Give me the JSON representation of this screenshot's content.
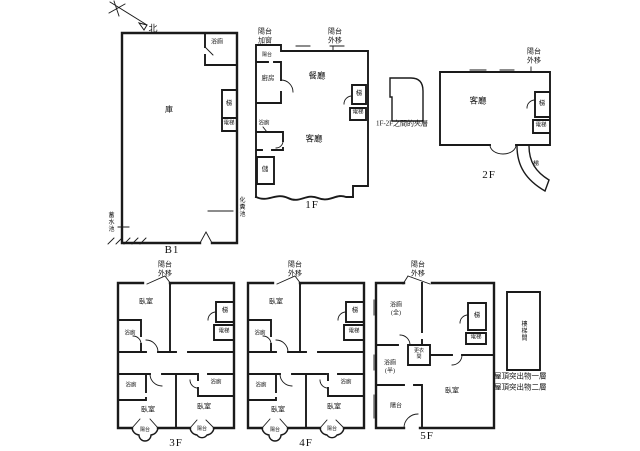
{
  "compass": {
    "north": "北"
  },
  "floors": {
    "b1": {
      "label": "B1",
      "main_room": "庫",
      "bath": "浴廁",
      "stair": "梯",
      "elevator": "電梯",
      "water_tank": "蓄水池",
      "septic_tank": "化糞池"
    },
    "f1": {
      "label": "1F",
      "balcony_window_note": "陽台\n加窗",
      "balcony_out_note": "陽台\n外移",
      "balcony": "陽台",
      "kitchen": "廚房",
      "dining": "餐廳",
      "living": "客廳",
      "bath": "浴廁",
      "storage": "儲",
      "stair": "梯",
      "elevator": "電梯"
    },
    "mezzanine_note": "1F-2F之間的夾層",
    "f2": {
      "label": "2F",
      "balcony_out_note": "陽台\n外移",
      "living": "客廳",
      "stair": "梯",
      "elevator": "電梯",
      "curved_stair": "梯"
    },
    "f3": {
      "label": "3F",
      "balcony_out_note": "陽台\n外移",
      "bedroom_top": "臥室",
      "bedroom_left": "臥室",
      "bedroom_right": "臥室",
      "bath_top": "浴廁",
      "bath_left": "浴廁",
      "bath_right": "浴廁",
      "stair": "梯",
      "elevator": "電梯",
      "balcony_left": "陽台",
      "balcony_right": "陽台"
    },
    "f4": {
      "label": "4F",
      "balcony_out_note": "陽台\n外移",
      "bedroom_top": "臥室",
      "bedroom_left": "臥室",
      "bedroom_right": "臥室",
      "bath_top": "浴廁",
      "bath_left": "浴廁",
      "bath_right": "浴廁",
      "stair": "梯",
      "elevator": "電梯",
      "balcony_left": "陽台",
      "balcony_right": "陽台"
    },
    "f5": {
      "label": "5F",
      "balcony_out_note": "陽台\n外移",
      "bath_full": "浴廁\n(全)",
      "bath_half": "浴廁\n(半)",
      "dressing": "更衣\n間",
      "balcony": "陽台",
      "bedroom": "臥室",
      "stair": "梯",
      "elevator": "電梯"
    },
    "roof": {
      "stairwell": "樓梯間",
      "note_line1": "屋頂突出物一層",
      "note_line2": "屋頂突出物二層"
    }
  },
  "colors": {
    "line": "#1a1a1a",
    "background": "#ffffff"
  }
}
